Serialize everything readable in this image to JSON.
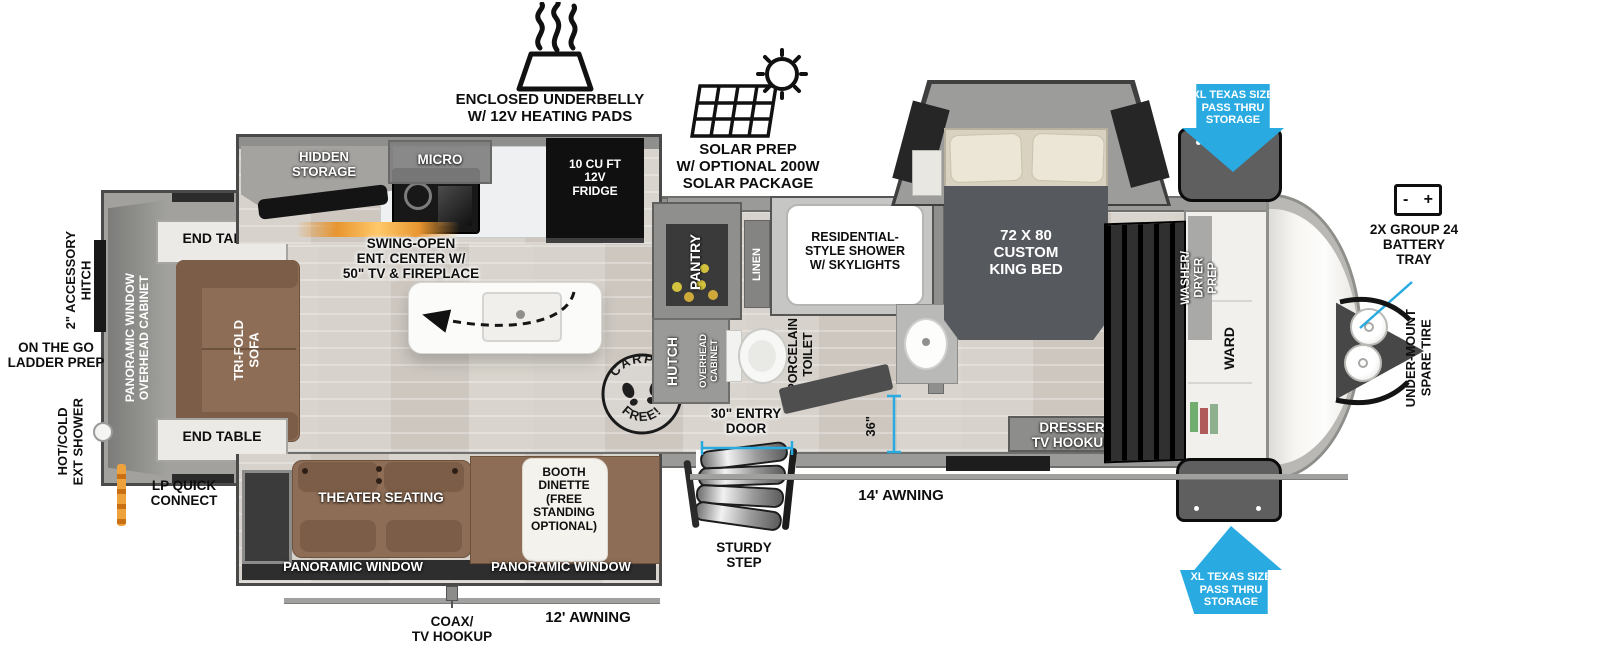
{
  "colors": {
    "arrow_blue": "#29ABE2",
    "measure_blue": "#2FA8E0",
    "furniture_brown": "#8D6D56",
    "floor_wood": "#D5D0C9",
    "wall_gray": "#9A9A98",
    "dark_fixture": "#1C1C1C",
    "fireplace_orange": "#E89A3C",
    "jar_yellow": "#D3C23D"
  },
  "callouts": {
    "underbelly": "ENCLOSED UNDERBELLY\nW/ 12V HEATING PADS",
    "solar": "SOLAR PREP\nW/ OPTIONAL 200W\nSOLAR PACKAGE",
    "pass_thru_top": "XL TEXAS SIZE\nPASS THRU\nSTORAGE",
    "pass_thru_bottom": "XL TEXAS SIZE\nPASS THRU\nSTORAGE",
    "battery_tray": "2X GROUP 24\nBATTERY\nTRAY",
    "battery_minus": "-",
    "battery_plus": "+",
    "under_mount_spare_tire": "UNDER-MOUNT\nSPARE TIRE",
    "accessory_hitch": "2\" ACCESSORY\nHITCH",
    "ladder_prep": "ON THE GO\nLADDER PREP",
    "ext_shower": "HOT/COLD\nEXT SHOWER",
    "lp_quick_connect": "LP QUICK\nCONNECT",
    "awning_14": "14' AWNING",
    "awning_12": "12' AWNING",
    "coax": "COAX/\nTV HOOKUP",
    "sturdy_step": "STURDY\nSTEP",
    "entry_door": "30\" ENTRY\nDOOR",
    "dim_36": "36\""
  },
  "rooms": {
    "hidden_storage": "HIDDEN\nSTORAGE",
    "micro": "MICRO",
    "fridge": "10 CU FT\n12V\nFRIDGE",
    "ent_center": "SWING-OPEN\nENT. CENTER W/\n50\" TV & FIREPLACE",
    "end_table_top": "END TABLE",
    "end_table_bottom": "END TABLE",
    "tri_fold_sofa": "TRI-FOLD\nSOFA",
    "rear_window_cabinet": "PANORAMIC WINDOW\nOVERHEAD CABINET",
    "theater_seating": "THEATER SEATING",
    "booth_dinette": "BOOTH\nDINETTE\n(FREE\nSTANDING\nOPTIONAL)",
    "panoramic_window_left": "PANORAMIC WINDOW",
    "panoramic_window_right": "PANORAMIC WINDOW",
    "pantry": "PANTRY",
    "linen": "LINEN",
    "shower": "RESIDENTIAL-\nSTYLE SHOWER\nW/ SKYLIGHTS",
    "hutch": "HUTCH",
    "hutch_cabinet": "OVERHEAD\nCABINET",
    "toilet": "PORCELAIN\nTOILET",
    "king_bed": "72 X 80\nCUSTOM\nKING BED",
    "dresser": "DRESSER\nTV HOOKUP",
    "washer_dryer": "WASHER/\nDRYER\nPREP",
    "ward": "WARD"
  },
  "stamp": {
    "top": "CARPET",
    "bottom": "FREE!"
  }
}
